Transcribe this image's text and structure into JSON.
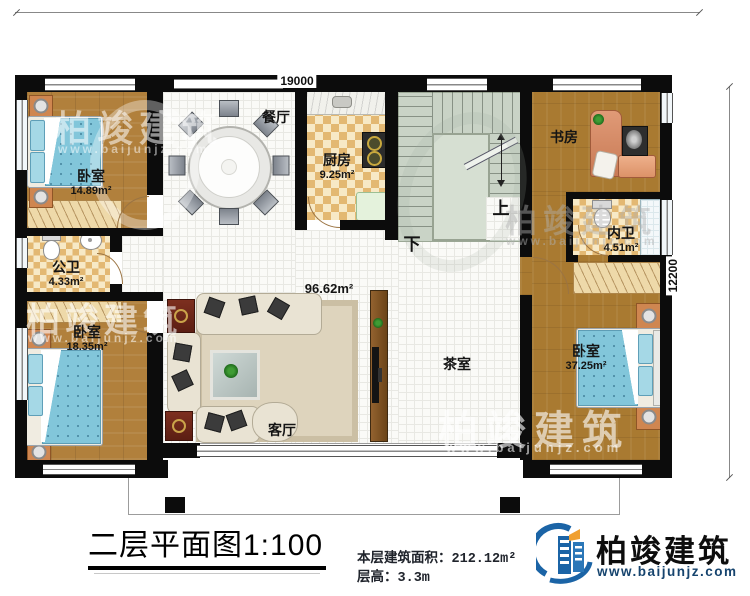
{
  "dimensions": {
    "top_width": "19000",
    "right_height": "12200"
  },
  "rooms": {
    "bedroom_top_left": {
      "label": "卧室",
      "area": "14.89m²"
    },
    "public_bath": {
      "label": "公卫",
      "area": "4.33m²"
    },
    "bedroom_bottom_left": {
      "label": "卧室",
      "area": "18.35m²"
    },
    "dining": {
      "label": "餐厅"
    },
    "kitchen": {
      "label": "厨房",
      "area": "9.25m²"
    },
    "study": {
      "label": "书房"
    },
    "inner_bath": {
      "label": "内卫",
      "area": "4.51m²"
    },
    "bedroom_right": {
      "label": "卧室",
      "area": "37.25m²"
    },
    "living": {
      "label": "客厅",
      "area": "96.62m²"
    },
    "tea_room": {
      "label": "茶室"
    }
  },
  "stairs": {
    "up": "上",
    "down": "下"
  },
  "footer": {
    "title": "二层平面图1:100",
    "area_label": "本层建筑面积：",
    "area_value": "212.12m²",
    "height_label": "层高：",
    "height_value": "3.3m"
  },
  "brand": {
    "name": "柏竣建筑",
    "website": "www.baijunjz.com"
  },
  "watermark": {
    "name": "柏竣建筑",
    "website": "www.baijunjz.com"
  },
  "colors": {
    "wall": "#0c0c0c",
    "wood": "#b1803c",
    "checker": "#e3b872",
    "stairs": "#c9d3c6",
    "bed": "#82c6da",
    "brand_blue": "#1b64a6",
    "brand_orange": "#f0a030"
  }
}
